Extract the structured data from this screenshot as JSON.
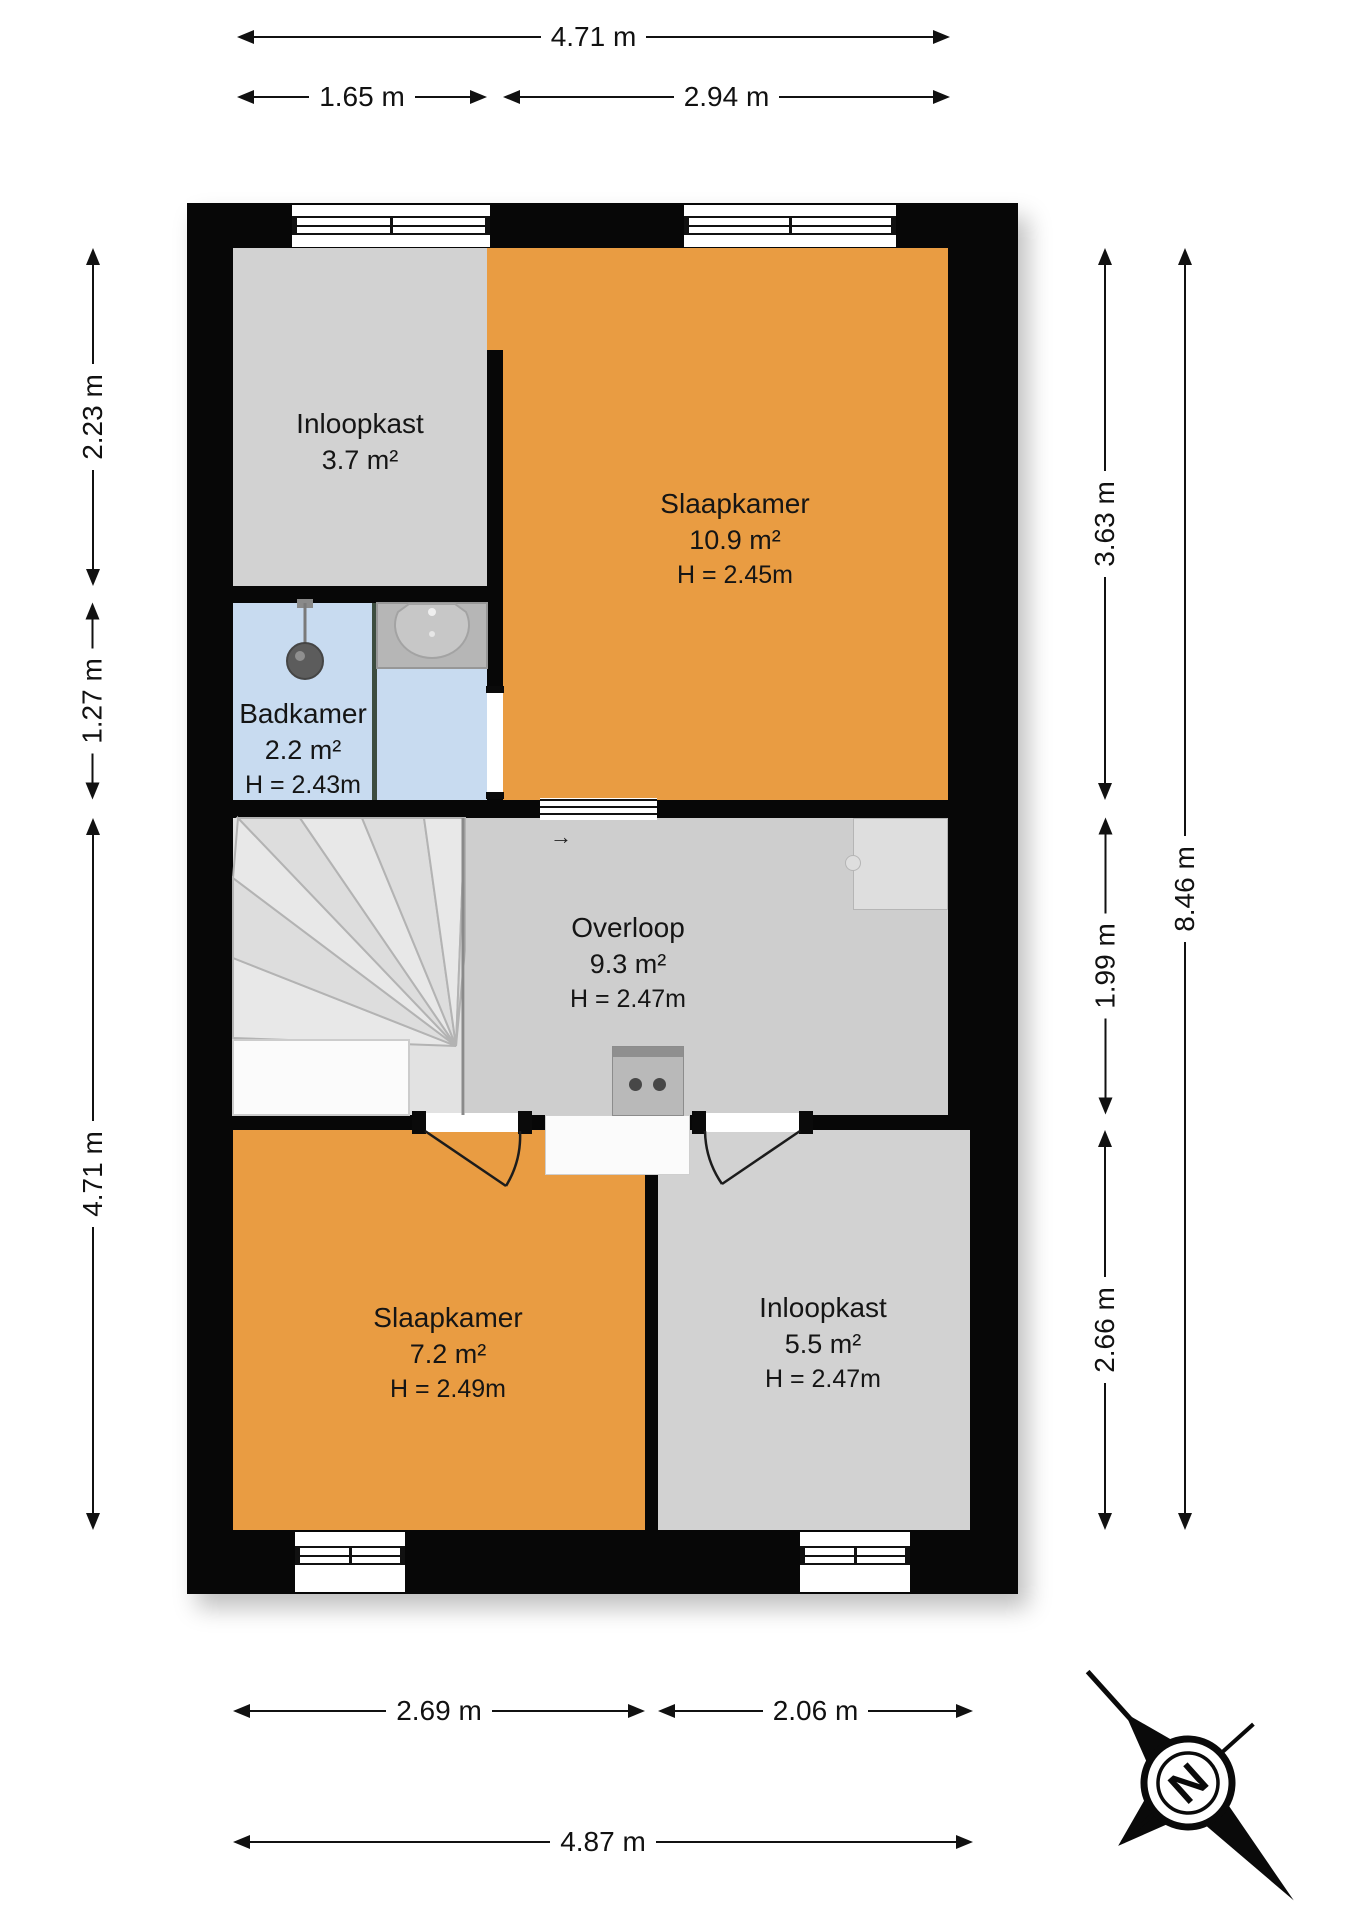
{
  "plan_title": "floor-plan-first-floor",
  "rooms": [
    {
      "id": "inloopkast-top",
      "name": "Inloopkast",
      "area": "3.7 m²",
      "height": ""
    },
    {
      "id": "slaapkamer-top",
      "name": "Slaapkamer",
      "area": "10.9 m²",
      "height": "H = 2.45m"
    },
    {
      "id": "badkamer",
      "name": "Badkamer",
      "area": "2.2 m²",
      "height": "H = 2.43m"
    },
    {
      "id": "overloop",
      "name": "Overloop",
      "area": "9.3 m²",
      "height": "H = 2.47m"
    },
    {
      "id": "slaapkamer-bottom",
      "name": "Slaapkamer",
      "area": "7.2 m²",
      "height": "H = 2.49m"
    },
    {
      "id": "inloopkast-bottom",
      "name": "Inloopkast",
      "area": "5.5 m²",
      "height": "H = 2.47m"
    }
  ],
  "dimensions": {
    "top_overall": "4.71 m",
    "top_left": "1.65 m",
    "top_right": "2.94 m",
    "left_upper": "2.23 m",
    "left_mid": "1.27 m",
    "left_lower": "4.71 m",
    "right_upper": "3.63 m",
    "right_mid": "1.99 m",
    "right_lower": "2.66 m",
    "right_overall": "8.46 m",
    "bottom_left": "2.69 m",
    "bottom_right": "2.06 m",
    "bottom_overall": "4.87 m"
  },
  "compass": {
    "label": "N"
  },
  "misc": {
    "door_arrow": "→"
  },
  "colors": {
    "wall": "#070707",
    "highlight_room": "#e99c42",
    "grey_room": "#d2d2d2",
    "overloop_grey": "#cecece",
    "bathroom_blue": "#c8dbf0"
  }
}
